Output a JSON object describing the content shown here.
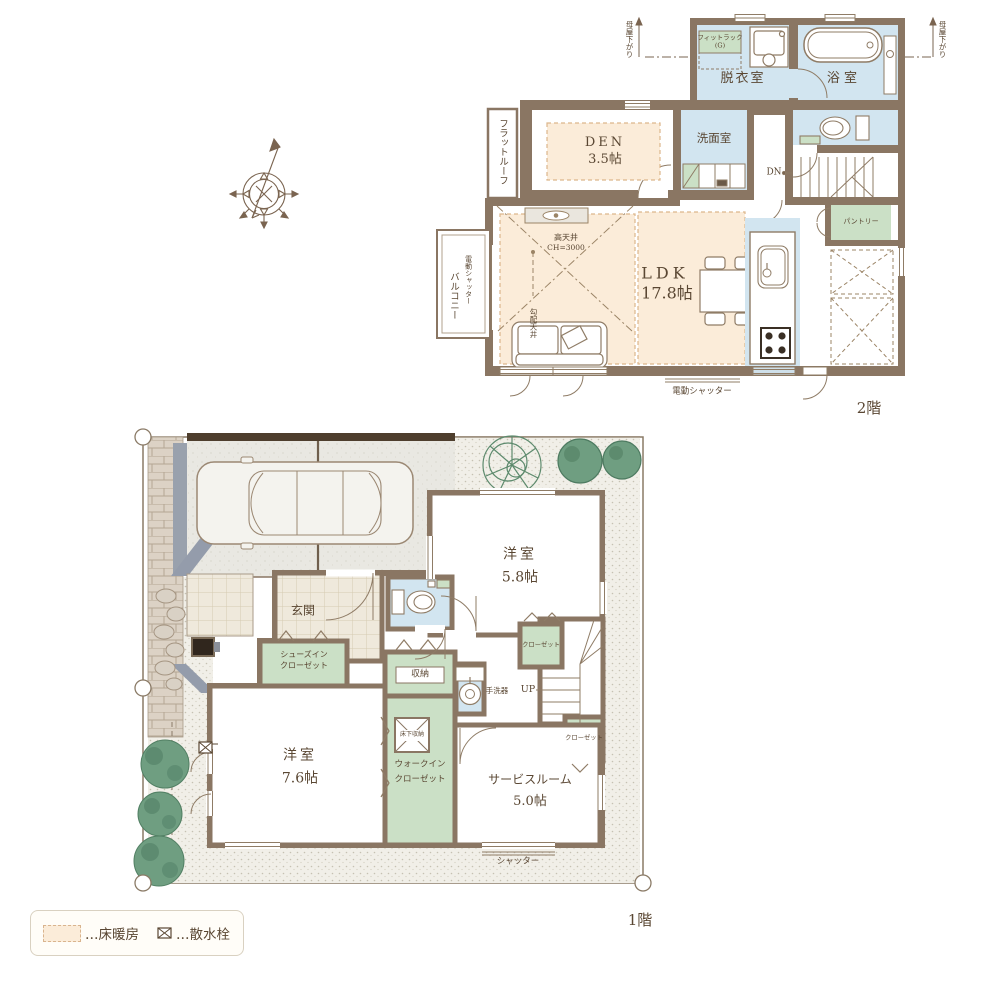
{
  "colors": {
    "wall": "#8a7663",
    "wet_room": "#d2e5f0",
    "storage_green": "#cbe0c6",
    "floor_heating_peach": "#fbecd9",
    "text_brown": "#5a4733"
  },
  "floor2": {
    "floor_label": "2階",
    "fitrack_line1": "フィットラック",
    "fitrack_line2": "(G)",
    "datsuishitsu": "脱衣室",
    "yokushitsu": "浴 室",
    "senmenshitsu": "洗面室",
    "dn": "DN",
    "pantry": "パントリー",
    "den_name": "DEN",
    "den_size": "3.5帖",
    "flat_roof": "フラットルーフ",
    "high_ceiling": "高天井",
    "ceiling_height": "CH=3000",
    "ldk_name": "LDK",
    "ldk_size": "17.8帖",
    "balcony": "バルコニー",
    "electric_shutter_side": "電動シャッター",
    "sloped_ceiling": "勾配天井",
    "electric_shutter_bottom": "電動シャッター",
    "moya_sagari_left": "母屋下がり",
    "moya_sagari_right": "母屋下がり"
  },
  "floor1": {
    "floor_label": "1階",
    "genkan": "玄関",
    "sic_line1": "シューズイン",
    "sic_line2": "クローゼット",
    "yoshitsu58_name": "洋室",
    "yoshitsu58_size": "5.8帖",
    "closet_a": "クローゼット",
    "closet_b": "クローゼット",
    "shuno": "収納",
    "yukashita_shuno": "床下収納",
    "tearaiki": "手洗器",
    "up": "UP",
    "wic_line1": "ウォークイン",
    "wic_line2": "クローゼット",
    "yoshitsu76_name": "洋室",
    "yoshitsu76_size": "7.6帖",
    "service_name": "サービスルーム",
    "service_size": "5.0帖",
    "shutter": "シャッター"
  },
  "legend": {
    "floor_heating": "…床暖房",
    "water_tap": "…散水栓"
  }
}
